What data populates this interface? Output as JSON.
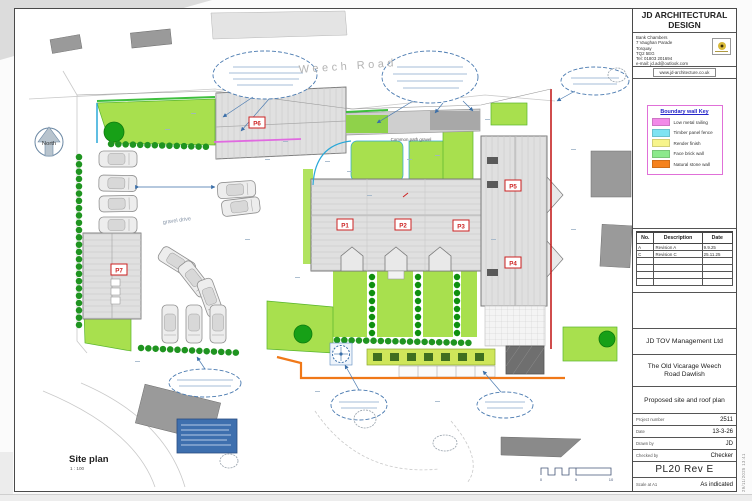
{
  "drawing": {
    "road_label": "Weech Road",
    "north_label": "North",
    "gravel_drive_label": "gravel drive",
    "common_path_label": "Common path  gravel",
    "plots": {
      "p1": "P1",
      "p2": "P2",
      "p3": "P3",
      "p4": "P4",
      "p5": "P5",
      "p6": "P6",
      "p7": "P7"
    },
    "view_title": "Site plan",
    "view_scale": "1 : 100",
    "scalebar": {
      "t0": "0",
      "t5": "5",
      "t10": "10"
    }
  },
  "titleblock": {
    "firm_line1": "JD ARCHITECTURAL",
    "firm_line2": "DESIGN",
    "address_lines": [
      "Bank Chambers",
      "7 Vaughan Parade",
      "Torquay",
      "TQ2 5EG",
      "Tel: 01803 201694",
      "e-mail: jd.ad@outlook.com"
    ],
    "website": "www.jd-architecture.co.uk",
    "legend": {
      "title": "Boundary wall Key",
      "items": [
        {
          "label": "Low metal railing",
          "color": "#f28ae8"
        },
        {
          "label": "Timber panel fence",
          "color": "#7fe3f2"
        },
        {
          "label": "Render finish",
          "color": "#f7f48b"
        },
        {
          "label": "Face brick  wall",
          "color": "#8ce98c"
        },
        {
          "label": "Natural stone  wall",
          "color": "#f5821e"
        }
      ]
    },
    "revision_table": {
      "headers": [
        "No.",
        "Description",
        "Date"
      ],
      "rows": [
        [
          "A",
          "Revision A",
          "9.9.25"
        ],
        [
          "C",
          "Revision C",
          "25.11.25"
        ]
      ]
    },
    "client": "JD TOV Management Ltd",
    "project_line1": "The Old Vicarage Weech",
    "project_line2": "Road Dawlish",
    "sheet_title": "Proposed site and roof plan",
    "fields": [
      {
        "label": "Project number",
        "value": "2511"
      },
      {
        "label": "Date",
        "value": "13-3-26"
      },
      {
        "label": "Drawn by",
        "value": "JD"
      },
      {
        "label": "Checked by",
        "value": "Checker"
      }
    ],
    "sheet_number": "PL20 Rev E",
    "scale_label": "Scale at A1",
    "scale_value": "As indicated",
    "plot_stamp": "29/11/2025 13:41"
  }
}
